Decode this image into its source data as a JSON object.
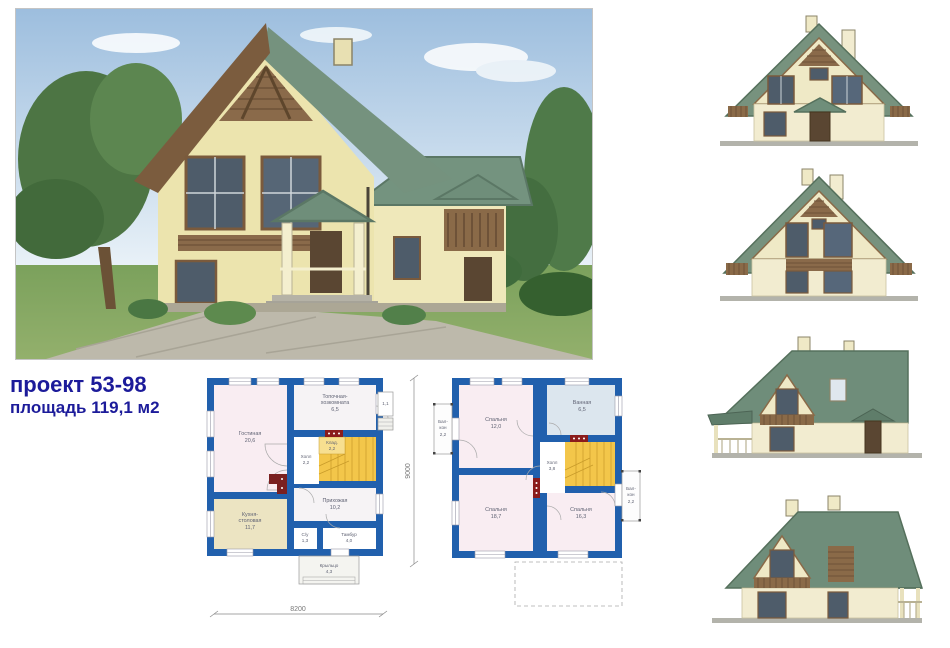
{
  "project": {
    "title": "проект 53-98",
    "area_line": "площадь 119,1 м2",
    "accent_color": "#1c1b9a"
  },
  "colors": {
    "plan_wall_blue": "#2160ad",
    "plan_room_pink": "#f9edf2",
    "plan_kitchen_beige": "#ece4c2",
    "plan_bath_blue": "#dce6ee",
    "plan_stairs_yellow": "#f3c64a",
    "vent_red": "#8b1c1c",
    "roof_green": "#75927e",
    "wall_cream": "#ece4ae",
    "wood_brown": "#8a6a48",
    "window_glass": "#4e5c6a"
  },
  "plan1": {
    "living_label": "Гостиная",
    "living_area": "20,6",
    "boiler_l1": "Топочная-",
    "boiler_l2": "хозкомната",
    "boiler_area": "6,5",
    "storage_label": "Клад.",
    "storage_area": "2,2",
    "hall_label": "Холл",
    "hall_area": "2,2",
    "entry_label": "Прихожая",
    "entry_area": "10,2",
    "kitchen_l1": "Кухня-",
    "kitchen_l2": "столовая",
    "kitchen_area": "11,7",
    "wc_label": "С/у",
    "wc_area": "1,3",
    "tambour_label": "Тамбур",
    "tambour_area": "4,0",
    "porch_label": "Крыльцо",
    "porch_area": "4,3",
    "sideporch_area": "1,1",
    "dim_width": "8200"
  },
  "plan2": {
    "bedroom1_label": "Спальня",
    "bedroom1_area": "12,0",
    "bath_label": "Ванная",
    "bath_area": "6,5",
    "hall_label": "Холл",
    "hall_area": "3,8",
    "bedroom2_label": "Спальня",
    "bedroom2_area": "18,7",
    "bedroom3_label": "Спальня",
    "bedroom3_area": "16,3",
    "balcony_l1": "Бал-",
    "balcony_l2": "кон",
    "balcony_area": "2,2",
    "dim_height": "9000"
  }
}
